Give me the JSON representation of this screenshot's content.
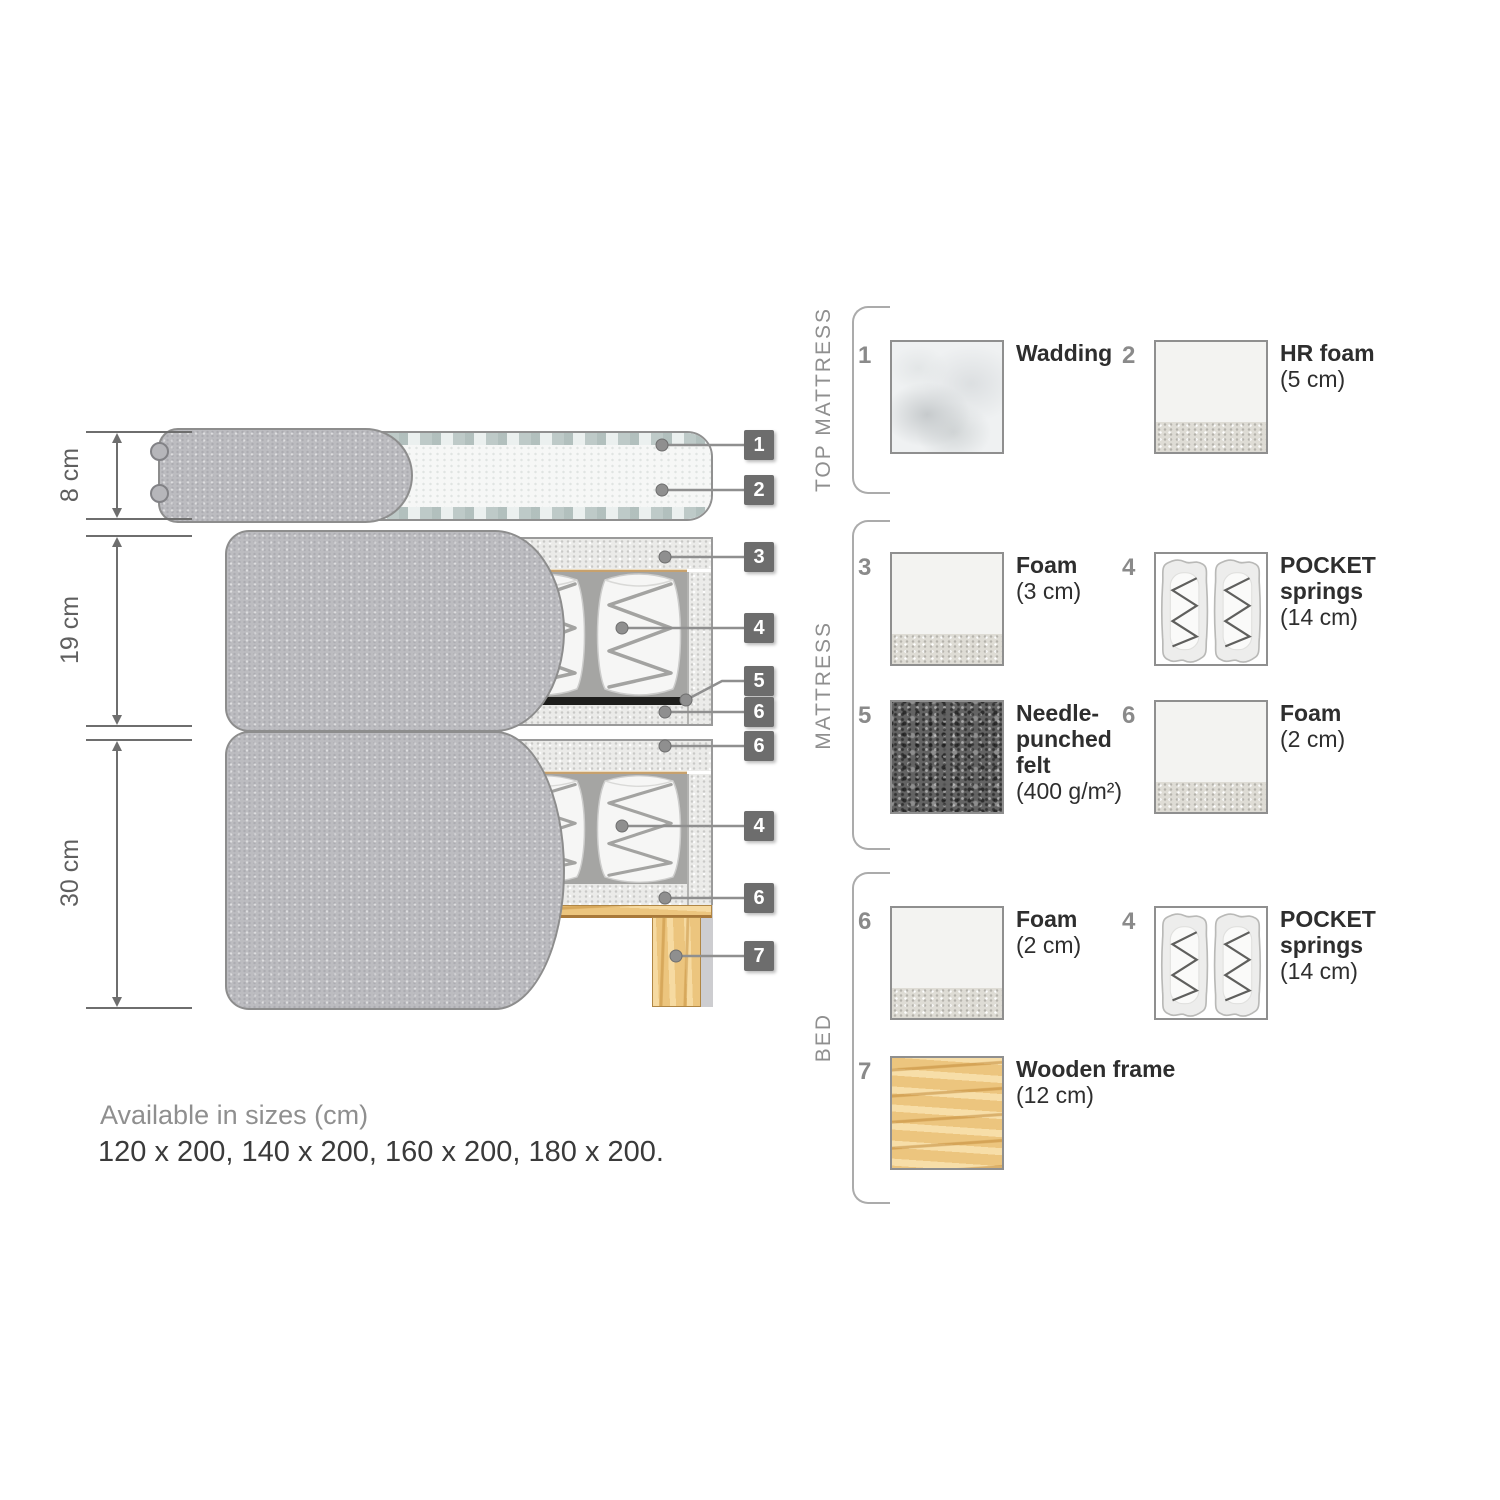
{
  "diagram": {
    "dimensions": [
      {
        "label": "8 cm"
      },
      {
        "label": "19 cm"
      },
      {
        "label": "30 cm"
      }
    ],
    "callouts": [
      {
        "number": "1"
      },
      {
        "number": "2"
      },
      {
        "number": "3"
      },
      {
        "number": "4"
      },
      {
        "number": "5"
      },
      {
        "number": "6"
      },
      {
        "number": "6"
      },
      {
        "number": "4"
      },
      {
        "number": "6"
      },
      {
        "number": "7"
      }
    ]
  },
  "legend": {
    "groups": [
      {
        "title": "TOP MATTRESS",
        "items": [
          {
            "number": "1",
            "name": "Wadding",
            "detail": "",
            "swatch": "wadding"
          },
          {
            "number": "2",
            "name": "HR foam",
            "detail": "(5 cm)",
            "swatch": "foam"
          }
        ]
      },
      {
        "title": "MATTRESS",
        "items": [
          {
            "number": "3",
            "name": "Foam",
            "detail": "(3 cm)",
            "swatch": "foam"
          },
          {
            "number": "4",
            "name": "POCKET springs",
            "detail": "(14 cm)",
            "swatch": "pocket-springs"
          },
          {
            "number": "5",
            "name": "Needle-punched felt",
            "detail": "(400 g/m²)",
            "swatch": "felt"
          },
          {
            "number": "6",
            "name": "Foam",
            "detail": "(2 cm)",
            "swatch": "foam"
          }
        ]
      },
      {
        "title": "BED",
        "items": [
          {
            "number": "6",
            "name": "Foam",
            "detail": "(2 cm)",
            "swatch": "foam"
          },
          {
            "number": "4",
            "name": "POCKET springs",
            "detail": "(14 cm)",
            "swatch": "pocket-springs"
          },
          {
            "number": "7",
            "name": "Wooden frame",
            "detail": "(12 cm)",
            "swatch": "wood"
          }
        ]
      }
    ]
  },
  "footer": {
    "title": "Available in sizes (cm)",
    "sizes": "120 x 200, 140 x 200, 160 x 200, 180 x 200."
  },
  "colors": {
    "fabric_gray": "#bcbcc0",
    "foam_speckle": "#ebebe9",
    "felt_dark": "#636363",
    "wood": "#ecc57e",
    "tag_background": "#6d6d6d",
    "leader_line": "#8f8f8f",
    "text_dark": "#2e2e2e",
    "text_gray": "#8f8f8f"
  }
}
